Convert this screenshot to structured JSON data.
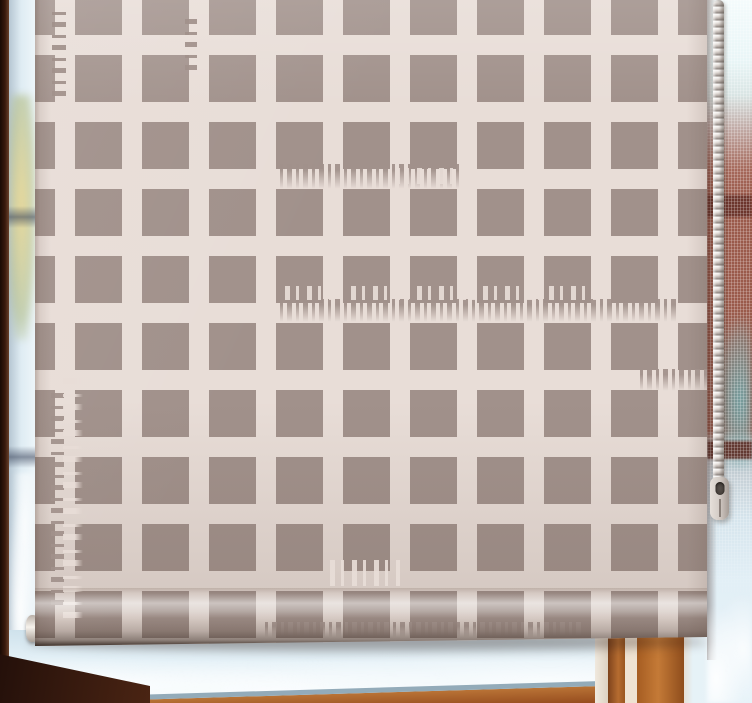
{
  "scene": {
    "kind": "photograph",
    "subject": "distressed check-pattern roller blind hanging in a frosted window"
  },
  "colors": {
    "blind_bg": "#e8ddd7",
    "blind_square": "#a1918b",
    "frame_dark": "#2b1309",
    "frame_orange": "#b4672c",
    "sill_steel": "#93abb9",
    "glass_light": "#e9f4f9",
    "glass_shade": "#c3d7e3",
    "brick_red": "#9a5a4b",
    "brick_band": "#69322a",
    "mesh_highlight": "#f2fbfc",
    "chain_bead": "#e9e4e0",
    "chain_connector": "#d3cbc5",
    "roll_edge": "#241710"
  },
  "pattern": {
    "name": "distressed-check",
    "square_px": 47,
    "pitch_px": 67,
    "gap_px": 20,
    "columns_visible": 11,
    "rows_visible": 10
  },
  "chain": {
    "beads_visible": true,
    "connector_visible": true
  }
}
